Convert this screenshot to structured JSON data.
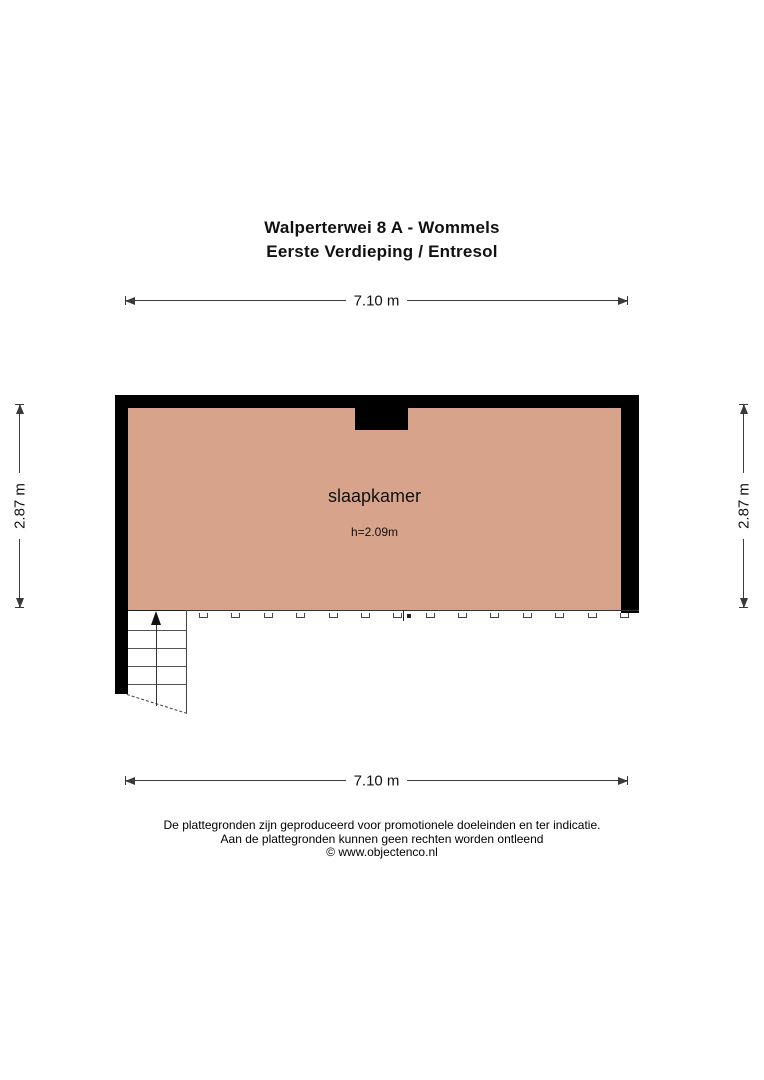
{
  "title": {
    "line1": "Walperterwei 8 A - Wommels",
    "line2": "Eerste Verdieping / Entresol"
  },
  "floor_plan": {
    "room": {
      "label": "slaapkamer",
      "ceiling_height": "h=2.09m"
    },
    "dimensions": {
      "width_top": "7.10 m",
      "width_bottom": "7.10 m",
      "height_left": "2.87 m",
      "height_right": "2.87 m"
    }
  },
  "colors": {
    "room_fill": "#d7a48b",
    "wall": "#000000",
    "line": "#3a3a3a"
  },
  "footer": {
    "line1": "De plattegronden zijn geproduceerd voor promotionele doeleinden en ter indicatie.",
    "line2": "Aan de plattegronden kunnen geen rechten worden ontleend",
    "line3": "© www.objectenco.nl"
  }
}
